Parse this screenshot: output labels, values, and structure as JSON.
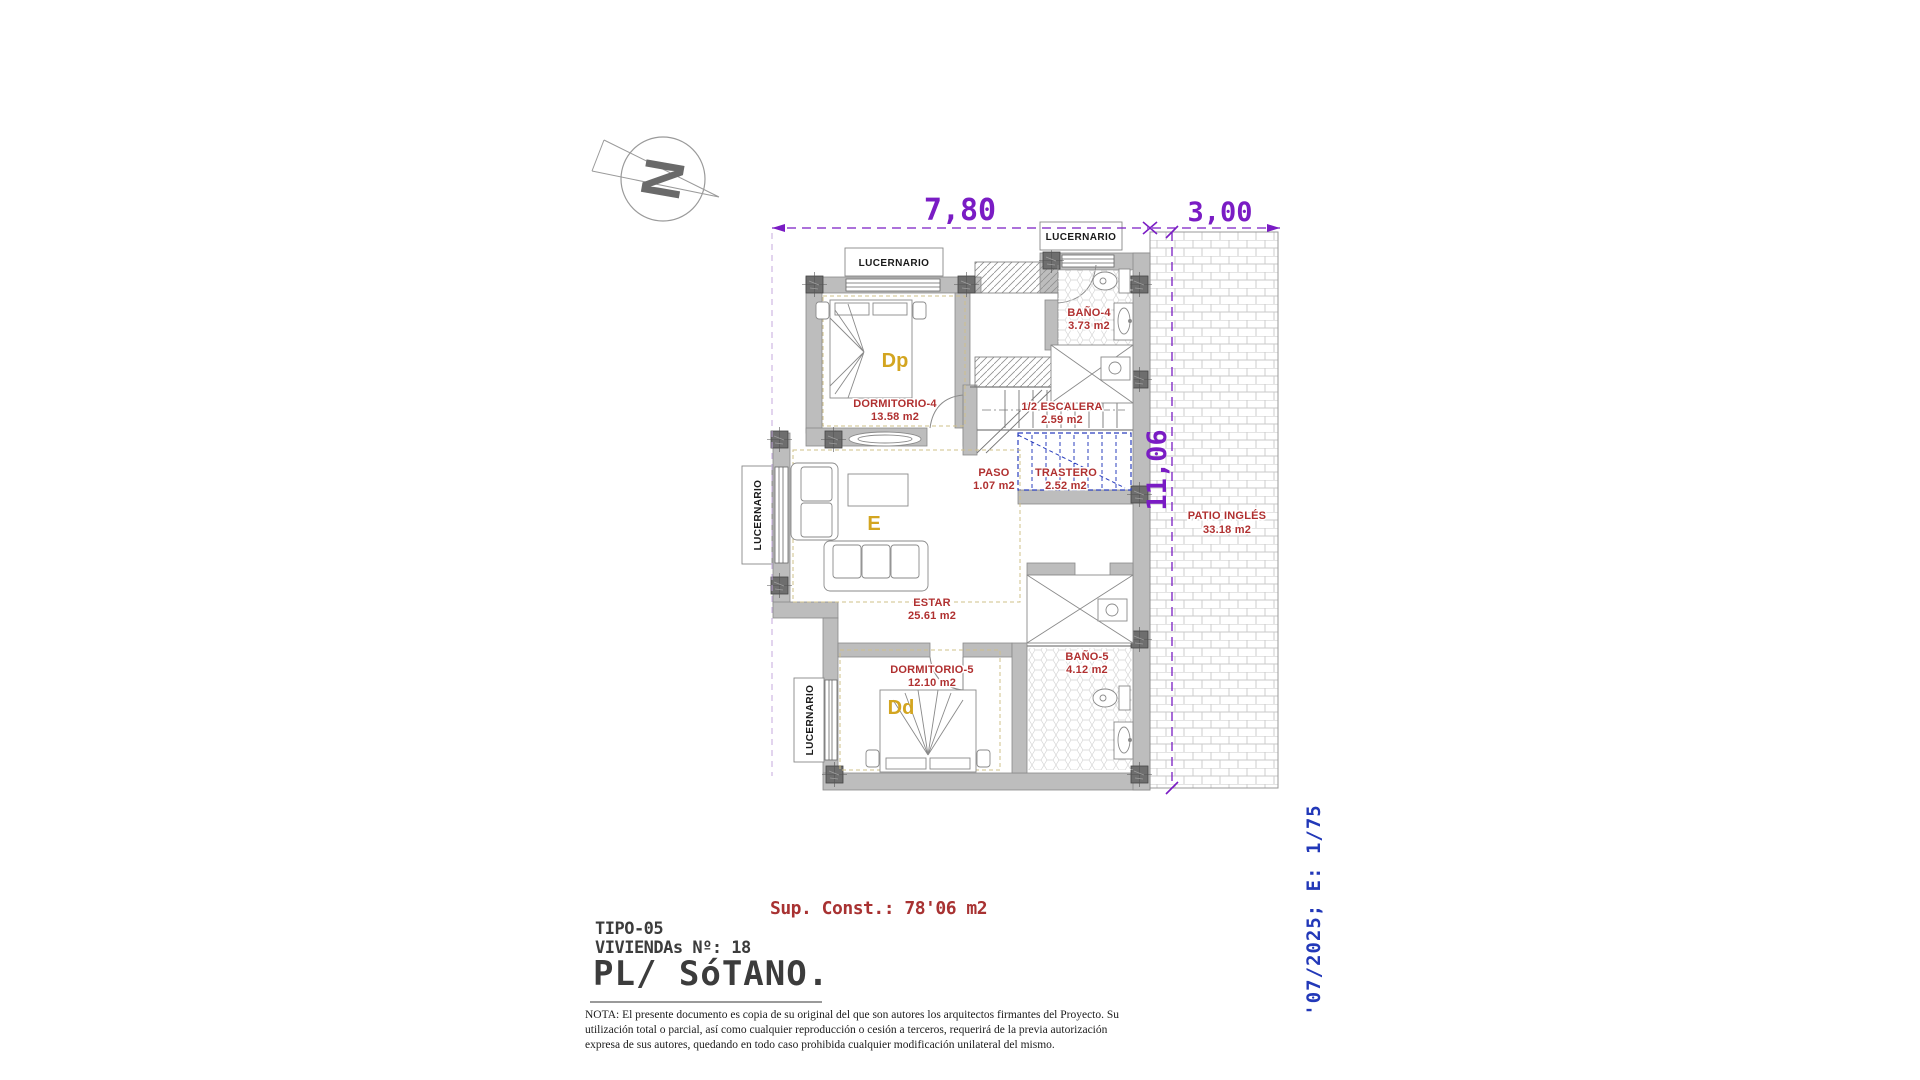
{
  "labels": {
    "lucernario": "LUCERNARIO"
  },
  "compass": {
    "letter": "N"
  },
  "dimensions": {
    "top_width": "7,80",
    "patio_width": "3,00",
    "side_height": "11,06"
  },
  "rooms": [
    {
      "name": "DORMITORIO-4",
      "area": "13.58 m2"
    },
    {
      "name": "BAÑO-4",
      "area": "3.73 m2"
    },
    {
      "name": "1/2 ESCALERA",
      "area": "2.59 m2"
    },
    {
      "name": "PASO",
      "area": "1.07 m2"
    },
    {
      "name": "TRASTERO",
      "area": "2.52 m2"
    },
    {
      "name": "ESTAR",
      "area": "25.61 m2"
    },
    {
      "name": "DORMITORIO-5",
      "area": "12.10 m2"
    },
    {
      "name": "BAÑO-5",
      "area": "4.12 m2"
    },
    {
      "name": "PATIO INGLÉS",
      "area": "33.18 m2"
    }
  ],
  "room_letters": {
    "dp": "Dp",
    "e": "E",
    "dd": "Dd"
  },
  "title_block": {
    "sup_const": "Sup. Const.: 78'06 m2",
    "tipo": "TIPO-05",
    "viviendas": "VIVIENDAs Nº: 18",
    "plano": "PL/ SóTANO.",
    "nota": "NOTA: El presente documento es copia de su original del que son autores los arquitectos firmantes del Proyecto. Su utilización total o parcial, así como cualquier reproducción o cesión a terceros, requerirá de la previa autorización expresa de sus autores, quedando en todo caso prohibida cualquier modificación unilateral del mismo.",
    "revision_scale": "'07/2025; E: 1/75"
  },
  "colors": {
    "label_red": "#b03030",
    "dim_purple": "#7a1cc4",
    "storage_blue": "#2b3fbe",
    "room_letter_gold": "#d3a520",
    "revision_blue": "#2238b8",
    "wall_gray": "#bdbdbd"
  }
}
